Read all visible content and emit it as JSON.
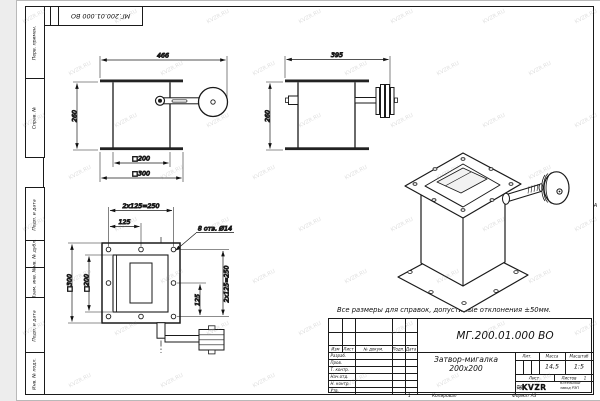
{
  "sheet": {
    "watermark": "KVZR.RU",
    "note": "Все размеры для справок, допустимые отклонения ±50мм.",
    "copied_label": "Копировал",
    "format_label": "Формат А3",
    "sheet_number": "1",
    "zone_marker": "А"
  },
  "top_stamp": {
    "doc_number": "МГ.200.01.000 ВО"
  },
  "margin_columns": {
    "perv_primen": "Перв. примен.",
    "sprav_no": "Справ. №",
    "podp_data_1": "Подп. и дата",
    "inv_dubl": "Инв. № дубл.",
    "vzam_inv": "Взам. инв. №",
    "podp_data_2": "Подп. и дата",
    "inv_podl": "Инв. № подл."
  },
  "title_block": {
    "doc_number": "МГ.200.01.000 ВО",
    "name": "Затвор-мигалка 200х200",
    "cols": {
      "izm": "Изм",
      "list": "Лист",
      "doc": "№ докум.",
      "podp": "Подп.",
      "data": "Дата"
    },
    "rows": {
      "razrab": "Разраб.",
      "prov": "Пров.",
      "tkontr": "Т. контр.",
      "nachotd": "Нач.отд.",
      "nkontr": "Н. контр.",
      "utv": "Утв."
    },
    "lit_label": "Лит.",
    "mass_label": "Масса",
    "scale_label": "Масштаб",
    "mass_value": "14,5",
    "scale_value": "1:5",
    "list_label": "Лист",
    "listov_label": "Листов",
    "listov_value": "1",
    "logo_text": "KVZR",
    "company": "Котельный завод РЭП"
  },
  "views": {
    "front": {
      "w": "466",
      "h": "260",
      "inner": "□200",
      "outer": "□300"
    },
    "side": {
      "w": "395",
      "h": "260"
    },
    "plan": {
      "top_total": "2x125=250",
      "top_half": "125",
      "right_total": "2x125=250",
      "right_half": "125",
      "left_outer": "□300",
      "left_inner": "□200",
      "holes": "8 отв. Ø14"
    }
  }
}
